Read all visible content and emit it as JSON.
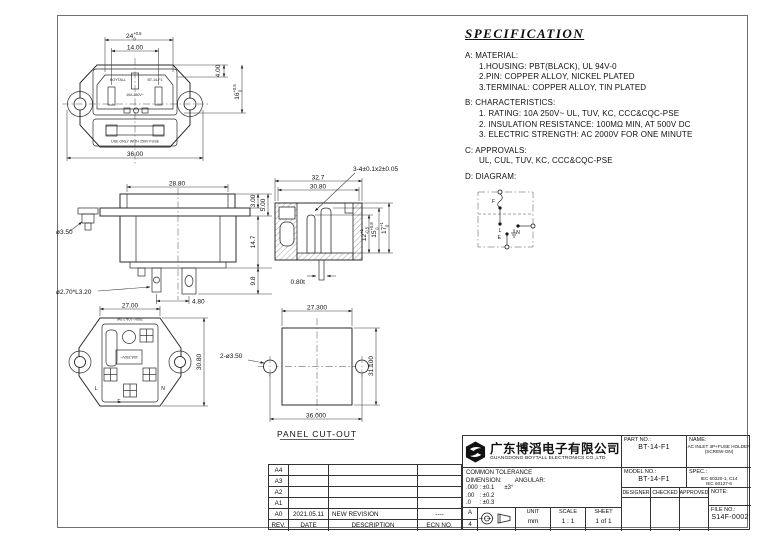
{
  "spec": {
    "title": "SPECIFICATION",
    "a": {
      "label": "A: MATERIAL:",
      "items": [
        "1.HOUSING: PBT(BLACK), UL 94V-0",
        "2.PIN: COPPER ALLOY, NICKEL PLATED",
        "3.TERMINAL: COPPER ALLOY, TIN PLATED"
      ]
    },
    "b": {
      "label": "B: CHARACTERISTICS:",
      "items": [
        "1. RATING: 10A 250V~ UL, TUV, KC, CCC&CQC-PSE",
        "2. INSULATION RESISTANCE: 100MΩ MIN, AT 500V DC",
        "3. ELECTRIC STRENGTH: AC 2000V FOR ONE MINUTE"
      ]
    },
    "c": {
      "label": "C: APPROVALS:",
      "items": [
        "UL, CUL, TUV, KC, CCC&CQC-PSE"
      ]
    },
    "d": {
      "label": "D: DIAGRAM:"
    }
  },
  "diagram": {
    "f": "F",
    "l": "L",
    "n": "N",
    "e": "E"
  },
  "views": {
    "front": {
      "dim_24": "24",
      "dim_24_up": "+0.5",
      "dim_24_dn": "0",
      "dim_14": "14.00",
      "dim_4": "4.00",
      "dim_16": "16",
      "dim_16_up": "+0.5",
      "dim_16_dn": "0",
      "dim_36": "36.00",
      "marking_brand": "BOYTALL",
      "marking_model": "BT-14-F1",
      "marking_rating": "10A 250V~",
      "fuse_label": "USE ONLY WITH 250V FUSE"
    },
    "side": {
      "dim_288": "28.80",
      "dim_3": "3.00",
      "dim_5": "5.00",
      "dim_147": "14.7",
      "dim_98": "9.8",
      "dim_hole": "ø3.50",
      "dim_pin": "ø2.70*L3.20",
      "dim_48": "4.80"
    },
    "section": {
      "callout": "3-4±0.1x2±0.05",
      "dim_327": "32.7",
      "dim_308": "30.80",
      "dim_12": "12",
      "dim_12_up": "+1",
      "dim_12_dn": "-0.5",
      "dim_15": "15",
      "dim_15_up": "+0.8",
      "dim_15_dn": "0",
      "dim_17": "17",
      "dim_17_up": "+1",
      "dim_17_dn": "0",
      "dim_t": "0.80t"
    },
    "rear": {
      "dim_27": "27.00",
      "dim_308": "30.80",
      "marking_top": "250V~10A 2.5W",
      "marking_mid": "10A 250V~",
      "term_l": "L",
      "term_n": "N",
      "term_e": "E"
    },
    "panel": {
      "title": "PANEL CUT-OUT",
      "dim_273": "27.300",
      "dim_311": "31.100",
      "dim_36": "36.000",
      "dim_holes": "2-ø3.50"
    }
  },
  "revisions": {
    "headers": {
      "rev": "REV.",
      "date": "DATE",
      "desc": "DESCRIPTION",
      "ecn": "ECN NO."
    },
    "rows": [
      {
        "rev": "A4",
        "date": "",
        "desc": "",
        "ecn": ""
      },
      {
        "rev": "A3",
        "date": "",
        "desc": "",
        "ecn": ""
      },
      {
        "rev": "A2",
        "date": "",
        "desc": "",
        "ecn": ""
      },
      {
        "rev": "A1",
        "date": "",
        "desc": "",
        "ecn": ""
      },
      {
        "rev": "A0",
        "date": "2021.05.11",
        "desc": "NEW REVISION",
        "ecn": "----"
      }
    ]
  },
  "title_block": {
    "company_cn": "广东博滔电子有限公司",
    "company_en": "GUANGDONG BOYTALL ELECTRONICS CO.,LTD",
    "part_no_label": "PART NO.:",
    "part_no": "BT-14-F1",
    "model_no_label": "MODEL NO.:",
    "model_no": "BT-14-F1",
    "name_label": "NAME:",
    "name_line1": "AC INLET 3P+FUSE HOLDER",
    "name_line2": "(SCREW-ON)",
    "spec_label": "SPEC.:",
    "spec_line1": "IEC 60320-1, C14",
    "spec_line2": "IEC 60127-6",
    "designer": "DESIGNER",
    "checked": "CHECKED",
    "approved": "APPROVED",
    "note_label": "NOTE:",
    "file_no_label": "FILE NO.:",
    "file_no": "S14F-0002",
    "tol_title": "COMMON TOLERANCE",
    "tol_dim_label": "DIMENSION:",
    "tol_ang_label": "ANGULAR:",
    "tol_row1": ".000 : ±0.1",
    "tol_row2": ".00   : ±0.2",
    "tol_row3": ".0     : ±0.3",
    "tol_ang_value": "±3°",
    "size_top": "A",
    "size_bottom": "4",
    "unit_label": "UNIT",
    "unit": "mm",
    "scale_label": "SCALE",
    "scale": "1 : 1",
    "sheet_label": "SHEET",
    "sheet": "1 of 1"
  }
}
